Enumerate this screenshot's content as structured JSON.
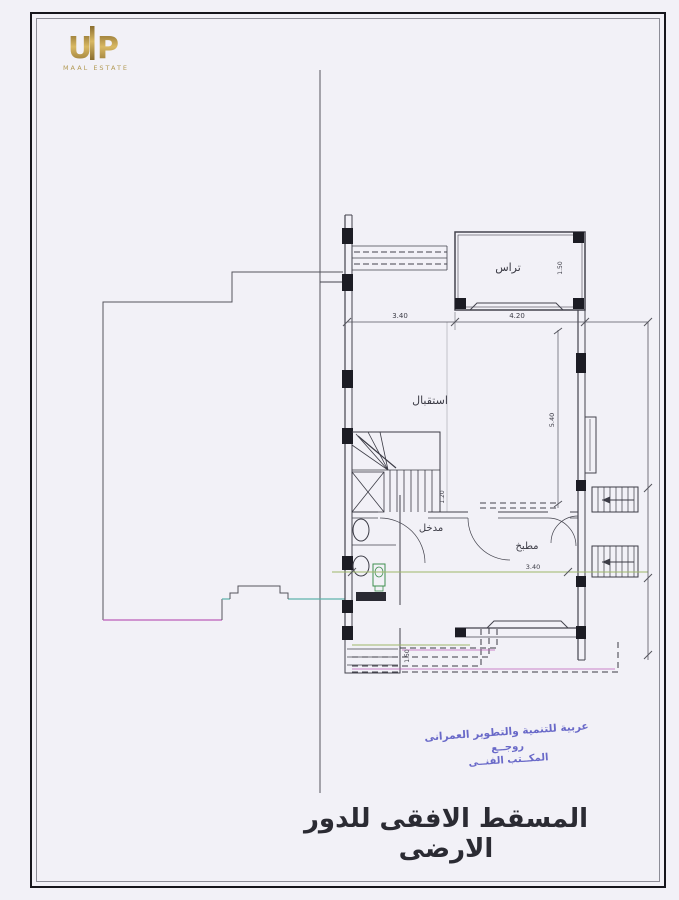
{
  "page": {
    "title": "المسقط الافقى للدور الارضى",
    "bg_color": "#f2f1f7",
    "border_color": "#16161c"
  },
  "logo": {
    "mark": "UP",
    "subtext": "MAAL ESTATE",
    "gold_color": "#b9953f"
  },
  "plan": {
    "rooms": [
      {
        "name": "terrace",
        "label": "تراس"
      },
      {
        "name": "reception",
        "label": "استقبال"
      },
      {
        "name": "entrance",
        "label": "مدخل"
      },
      {
        "name": "kitchen",
        "label": "مطبخ"
      }
    ],
    "dims": [
      "3.40",
      "4.20",
      "3.40",
      "5.40",
      "1.50",
      "1.20",
      "1.50"
    ],
    "colors": {
      "line": "#44444e",
      "column": "#1c1c24",
      "parcel_magenta": "#bb5cb8",
      "utility_teal": "#5fb3ab",
      "dim_green": "#9fb86a",
      "stamp_blue": "#5b5bc4"
    }
  },
  "stamp": {
    "line1": "عربية للتنمية والتطوير العمرانى",
    "line2": "روجــع",
    "line3": "المكــتب الفنــى"
  }
}
